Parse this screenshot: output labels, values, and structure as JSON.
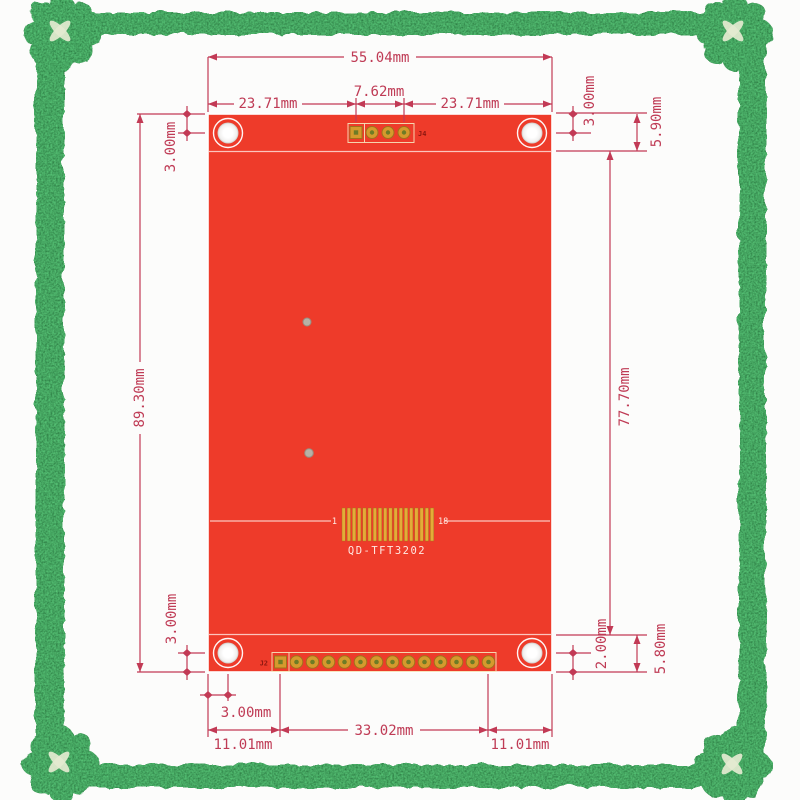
{
  "image_kind": "PCB dimensional drawing of a TFT display module, framed product photo",
  "colors": {
    "bg": "#fcfcfb",
    "board-red": "#ee3b2a",
    "dim": "#c23a55",
    "dim-text": "#bf3b55",
    "gold": "#d59a2d",
    "gold-bright": "#e3ac38",
    "gold-dark": "#a0721c",
    "pad-center": "#6e7c26",
    "pad-box": "#f5e7bd",
    "silk": "#ffe9e2",
    "ref-label": "#8a1710",
    "frame-green": "#15641b",
    "frame-cutout": "#e4ead0"
  },
  "frame": {
    "style": "ornate green textured border with quatrefoil corner rosettes"
  },
  "board": {
    "model": "QD-TFT3202",
    "connectors": {
      "top": "J4",
      "bottom": "J2"
    },
    "fpc": {
      "first_pin_label": "1",
      "last_pin_label": "18",
      "pin_count": 18
    },
    "j4_pin_count": 4,
    "j2_pin_count": 14,
    "mounting_hole_count": 4
  },
  "dimensions": {
    "top_total_width": "55.04mm",
    "top_left_span": "23.71mm",
    "top_pin_span": "7.62mm",
    "top_right_span": "23.71mm",
    "left_total_height": "89.30mm",
    "right_inner_height": "77.70mm",
    "hole_offset_top_left": "3.00mm",
    "hole_offset_top_right": "3.00mm",
    "top_strip_height": "5.90mm",
    "hole_offset_bottom_left": "3.00mm",
    "pin_row_offset_bottom_right": "2.00mm",
    "bottom_strip_height": "5.80mm",
    "hole_offset_bottom_x": "3.00mm",
    "bottom_left_edge_span": "11.01mm",
    "bottom_pin_row_span": "33.02mm",
    "bottom_right_edge_span": "11.01mm"
  }
}
